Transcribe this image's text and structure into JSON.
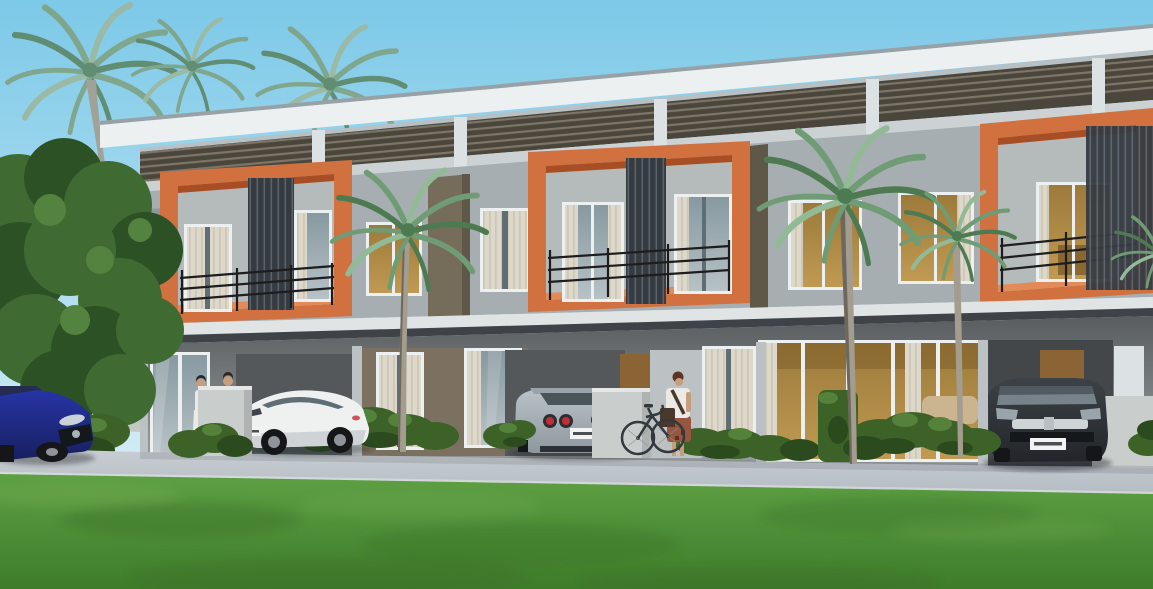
{
  "meta": {
    "type": "architectural-3d-rendering",
    "title": "Modern two-storey townhouse row with orange balcony frames, carports, palms and lawn"
  },
  "scene": {
    "time_of_day": "day",
    "sky": "clear light-blue sky",
    "building": {
      "storeys": 2,
      "units_visible": 5,
      "roof": "flat white overhanging roof with dark horizontal clerestory louvers beneath",
      "balconies": "three projecting orange box frames with black metal railings and dark vertical louver screens",
      "walls": "light grey render with taupe divider fins",
      "ground_floor": "recessed carports, full-height glazed sliding doors with sheer curtains, warm-lit interiors"
    },
    "vehicles": [
      {
        "name": "blue-sedan",
        "color": "dark blue",
        "view": "front three-quarter",
        "position": "far left, cropped by image edge"
      },
      {
        "name": "white-coupe",
        "color": "white",
        "view": "side, nose left",
        "position": "left unit carport"
      },
      {
        "name": "silver-sports-car",
        "color": "silver",
        "view": "rear",
        "position": "middle unit carport"
      },
      {
        "name": "black-suv",
        "color": "black",
        "view": "front",
        "position": "right unit carport"
      }
    ],
    "people": [
      {
        "name": "woman-in-white",
        "position": "standing by left unit entrance"
      },
      {
        "name": "man-in-dark-suit",
        "position": "behind low wall at left unit"
      },
      {
        "name": "person-with-bicycle",
        "position": "centre walkway beside leaning bicycle"
      }
    ],
    "objects": [
      {
        "name": "bicycle",
        "position": "leaning on centre low wall"
      },
      {
        "name": "license-plates",
        "note": "small white plates, characters illegible"
      }
    ],
    "landscape": [
      "dense tropical trees and palm crowns on the left",
      "three foreground palm trees in front of the facade",
      "trimmed hedges and shrubs along the frontage",
      "light grey paved driveway strip",
      "wide green lawn filling the foreground"
    ]
  },
  "colors": {
    "sky_top": "#7cc9e8",
    "sky_low": "#d8eef6",
    "roof_top": "#97a1a6",
    "fascia": "#ecf0f1",
    "soffit": "#b9c0c3",
    "louver_dark": "#4b463b",
    "louver_lite": "#7d7668",
    "beam": "#ccd2d4",
    "pillar": "#dce1e3",
    "wall": "#a6aeb1",
    "wall_shade": "#8f979b",
    "fin": "#766c5a",
    "fin_dark": "#5f5748",
    "orange": "#d0713f",
    "orange_dark": "#a84e25",
    "orange_lite": "#e28b58",
    "inner_wall": "#b5bbba",
    "slat_dark": "#363b41",
    "slat_lite": "#5a626b",
    "railing": "#1d1d1d",
    "slab": "#e0e4e5",
    "under_slab": "#3f4347",
    "gf_top": "#595d60",
    "gf_bot": "#9aa0a2",
    "tan_wall": "#7c7060",
    "column": "#bcc1c3",
    "carport": "#54585a",
    "carport_dark": "#43474a",
    "glass_hi": "#b7c2c6",
    "glass_lo": "#8799a1",
    "glass_dark": "#5f6d74",
    "curtain": "#ddd8ca",
    "curtain_dk": "#c9c3b4",
    "lit": "#9c7a3a",
    "lit_hi": "#c09a52",
    "sofa": "#cbb58e",
    "door": "#8a6434",
    "lowwall": "#c9cdcb",
    "lowwall_side": "#aeb3b2",
    "road": "#b5bcc3",
    "road_hi": "#c8ced3",
    "curb": "#d6dbdd",
    "grass_hi": "#5fa044",
    "grass_lo": "#3e7c2a",
    "grass_dk": "#2f6621",
    "grass_lt": "#7ab457",
    "bush": "#3d6228",
    "bush_hi": "#55823a",
    "bush_dk": "#2b4b1e",
    "tree": "#3f6b33",
    "tree_hi": "#54823f",
    "tree_dk": "#2c5124",
    "palm": "#6f9c74",
    "palm_hi": "#93ba97",
    "palm_dk": "#4e7a52",
    "palm_bg_a": "#7fa384",
    "palm_bg_b": "#5d8666",
    "palm_bg_c": "#9db89f",
    "trunk": "#a39d8f",
    "trunk_dk": "#6e685c",
    "boundary_wall": "#c3c8c5",
    "pole": "#9aa0a0",
    "car_blue": "#2734a6",
    "car_blue_dk": "#17205f",
    "car_blue_glass": "#252c52",
    "car_white": "#eff1f1",
    "car_white_sh": "#c9ced1",
    "car_silver": "#bac3c9",
    "car_silver_dk": "#8e979d",
    "car_black": "#22262a",
    "car_black_hi": "#3c4247",
    "tyre": "#141618",
    "rim": "#8e949a",
    "tail_red": "#c12f35",
    "plate": "#f2f3f2",
    "plate_txt": "#4a4f52",
    "skin": "#c79e7d",
    "hair_dark": "#2e2620",
    "hair_red": "#5e342a",
    "shirt": "#eceae6",
    "suit": "#2f3338",
    "skirt": "#96563f",
    "bag": "#4a382c",
    "bike": "#33383c"
  }
}
